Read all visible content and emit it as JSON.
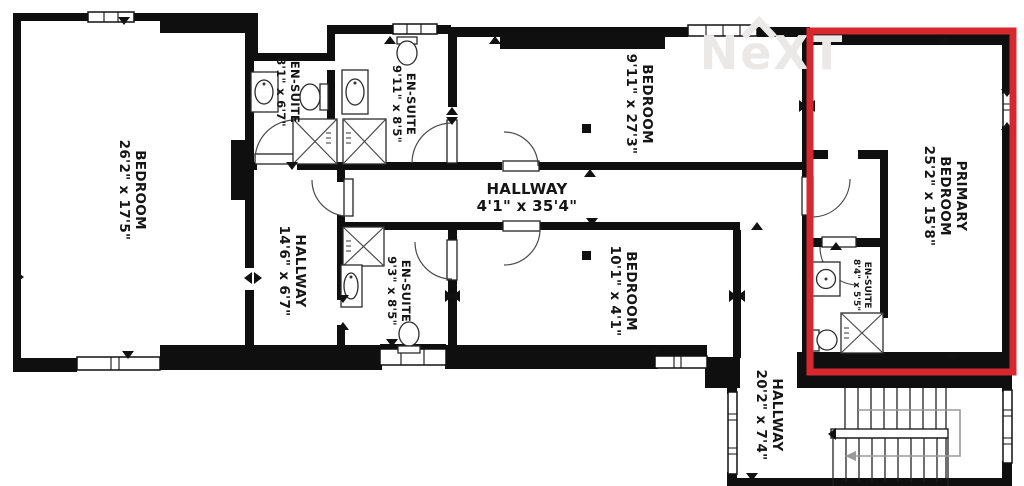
{
  "floorplan": {
    "watermark_text": "NeXT",
    "highlight_color": "#d7282f",
    "rooms": [
      {
        "id": "bedroom-left",
        "name": "BEDROOM",
        "dims": "26'2\" x 17'5\""
      },
      {
        "id": "en-suite-top-left",
        "name": "EN-SUITE",
        "dims": "8'1\" x 6'7\""
      },
      {
        "id": "en-suite-top-mid",
        "name": "EN-SUITE",
        "dims": "9'11\" x 8'5\""
      },
      {
        "id": "bedroom-top",
        "name": "BEDROOM",
        "dims": "9'11\" x 27'3\""
      },
      {
        "id": "primary-bedroom",
        "line1": "PRIMARY",
        "name": "BEDROOM",
        "dims": "25'2\" x 15'8\""
      },
      {
        "id": "hallway-main",
        "name": "HALLWAY",
        "dims": "4'1\" x 35'4\""
      },
      {
        "id": "hallway-left",
        "name": "HALLWAY",
        "dims": "14'6\" x 6'7\""
      },
      {
        "id": "en-suite-mid",
        "name": "EN-SUITE",
        "dims": "9'3\" x 8'5\""
      },
      {
        "id": "bedroom-mid",
        "name": "BEDROOM",
        "dims": "10'1\" x 4'1\""
      },
      {
        "id": "en-suite-primary",
        "name": "EN-SUITE",
        "dims": "8'4\" x 5'5\""
      },
      {
        "id": "hallway-bottom",
        "name": "HALLWAY",
        "dims": "20'2\" x 7'4\""
      }
    ]
  }
}
